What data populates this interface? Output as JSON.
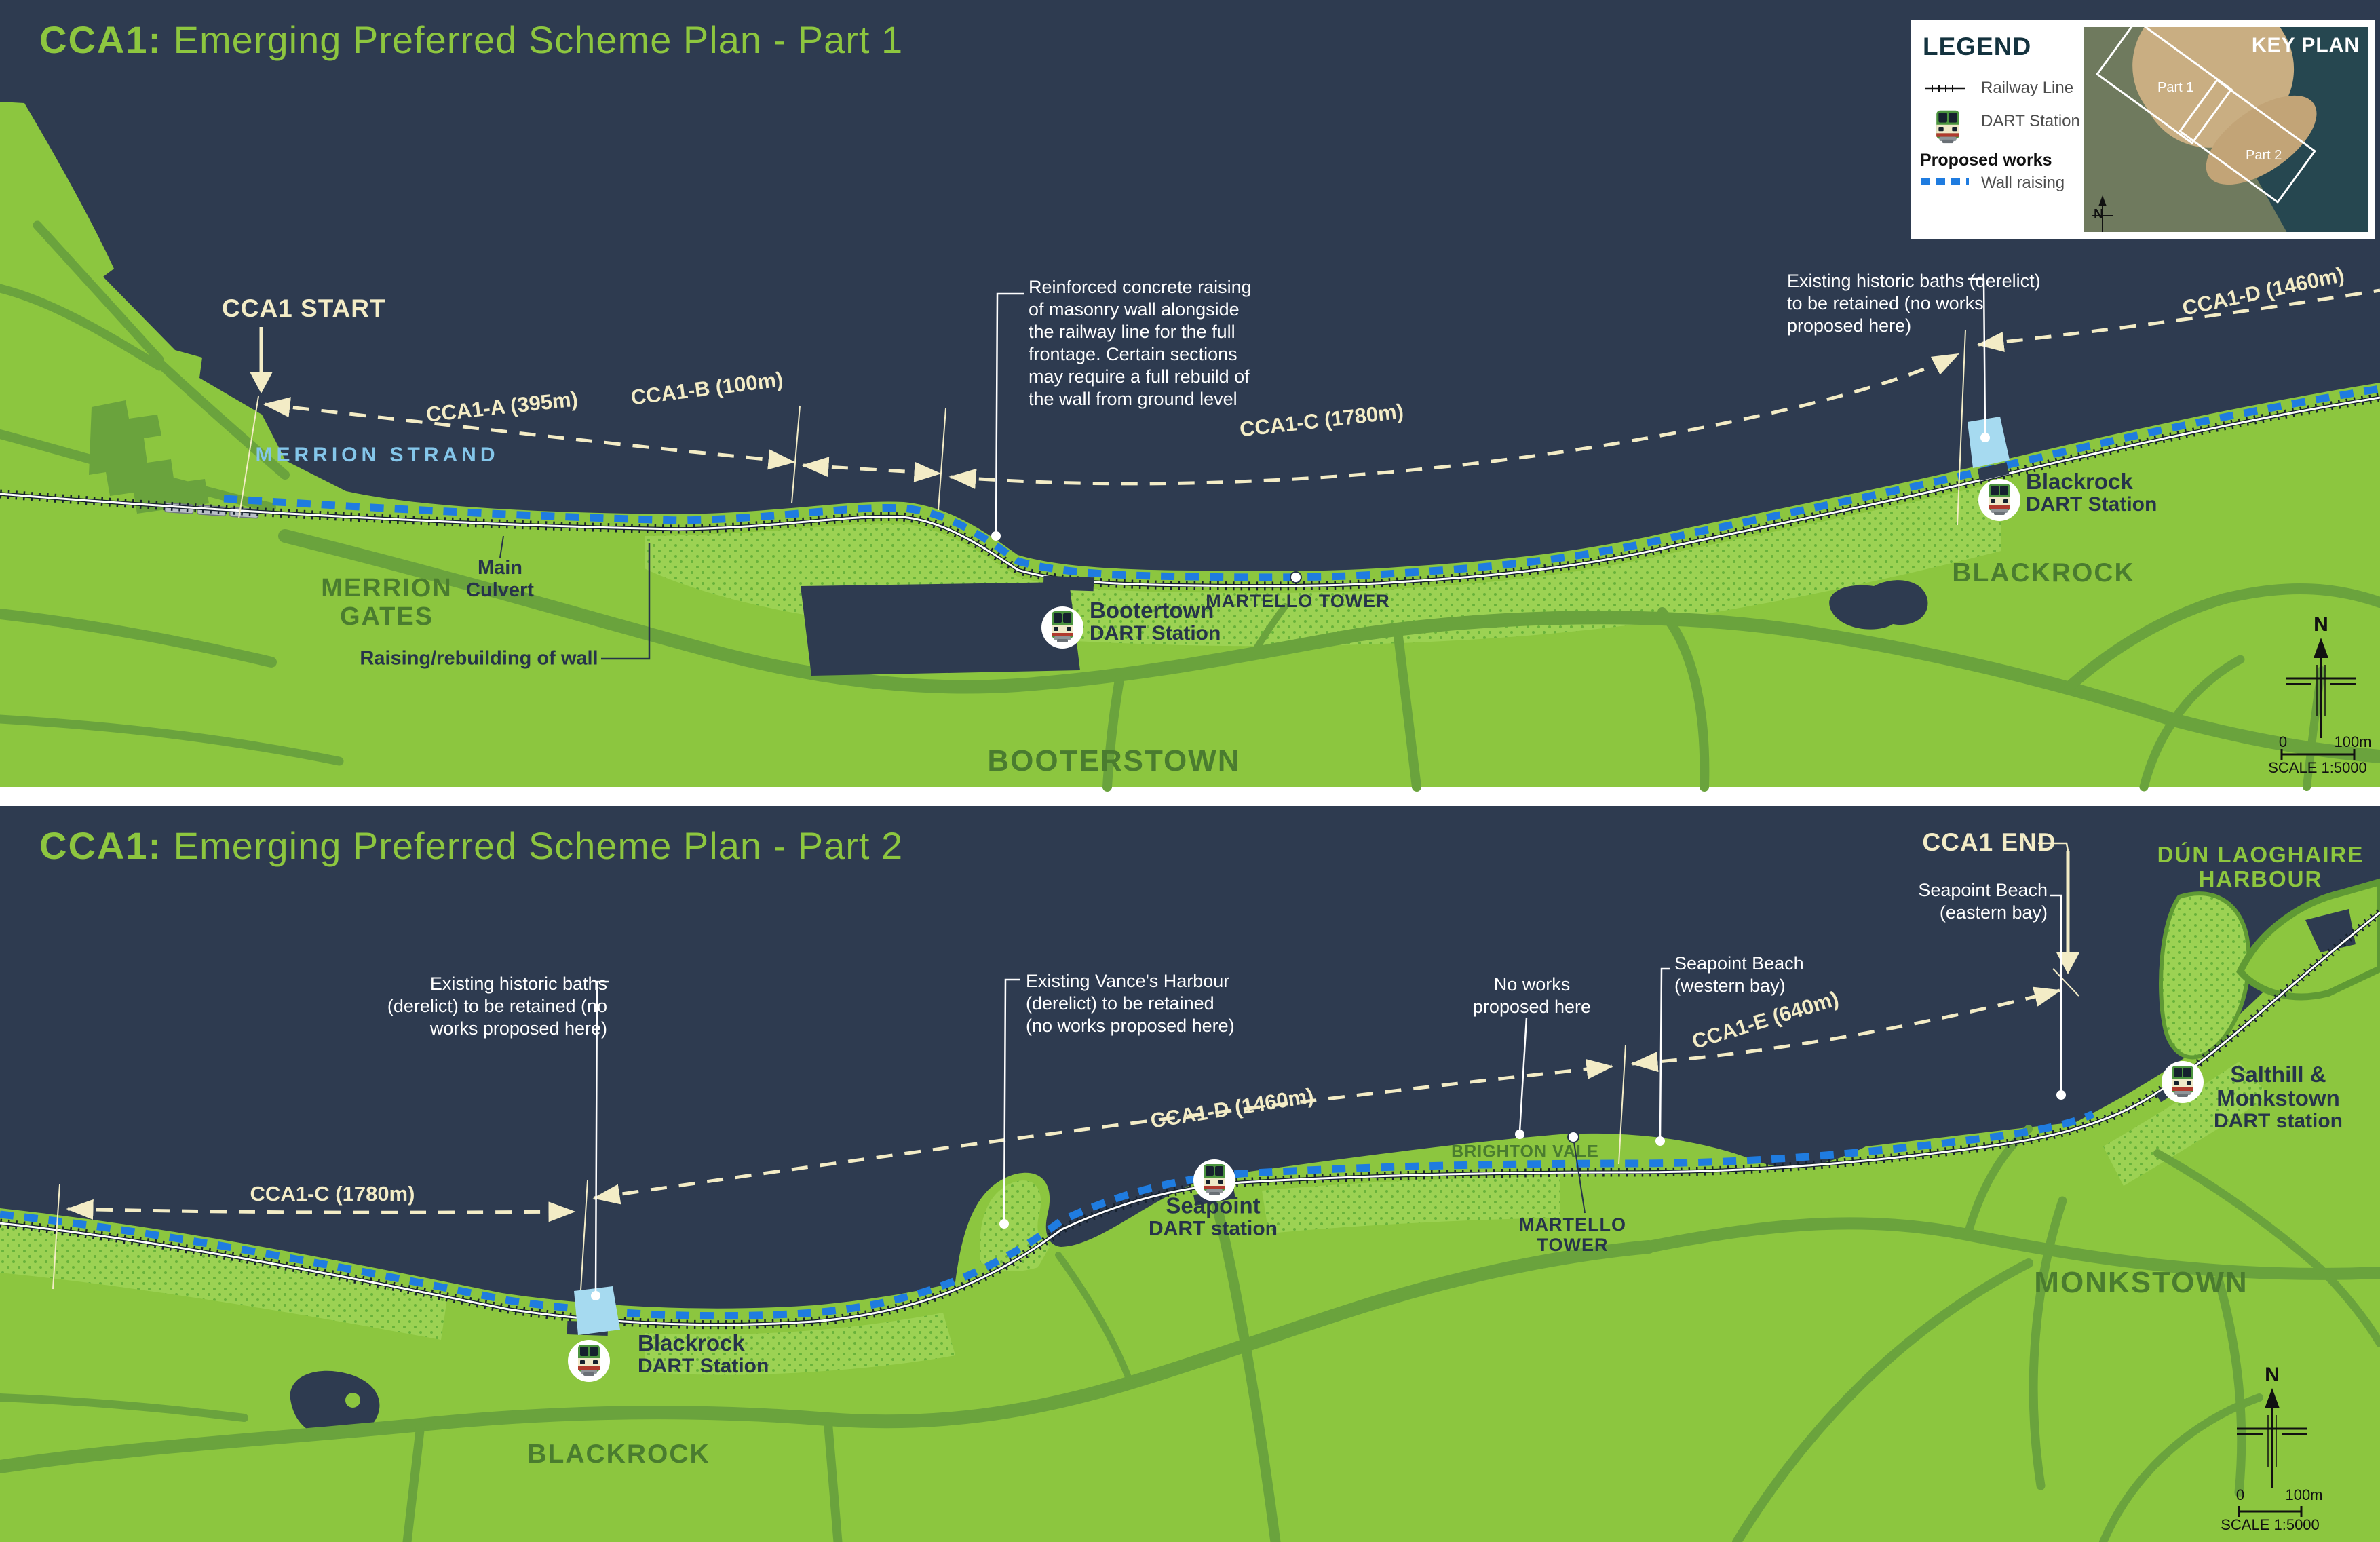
{
  "colors": {
    "sea": "#2e3b50",
    "land": "#8cc63f",
    "land_dotted": "#9cd253",
    "roads": "#6aa33d",
    "wall_raising_blue": "#1f7ce0",
    "dimension_cream": "#f3ecc6",
    "title_green": "#8dc63f",
    "area_label_green": "#4a7c2f",
    "navy_text": "#26344a",
    "strand_blue": "#84c6ea",
    "baths_blue": "#a6daf0"
  },
  "legend": {
    "title": "LEGEND",
    "railway_label": "Railway Line",
    "dart_label": "DART Station",
    "proposed_works": "Proposed works",
    "wall_label": "Wall raising"
  },
  "keyplan": {
    "title": "KEY PLAN",
    "part1": "Part 1",
    "part2": "Part 2",
    "north": "N"
  },
  "part1": {
    "title_bold": "CCA1:",
    "title_rest": " Emerging Preferred Scheme Plan - Part 1",
    "start_label": "CCA1 START",
    "dims": {
      "a": "CCA1-A (395m)",
      "b": "CCA1-B (100m)",
      "c": "CCA1-C (1780m)",
      "d": "CCA1-D (1460m)"
    },
    "merrion_strand": "MERRION STRAND",
    "merrion_gates": [
      "MERRION",
      "GATES"
    ],
    "main_culvert": [
      "Main",
      "Culvert"
    ],
    "raising_wall": "Raising/rebuilding of wall",
    "reinforced_note": [
      "Reinforced concrete raising",
      "of masonry wall alongside",
      "the railway line for the full",
      "frontage. Certain sections",
      "may require a full rebuild of",
      "the wall from ground level"
    ],
    "baths_note": [
      "Existing historic baths (derelict)",
      "to be retained (no works",
      "proposed here)"
    ],
    "martello": "MARTELLO TOWER",
    "stations": {
      "booterstown": {
        "name": "Bootertown",
        "sub": "DART Station"
      },
      "blackrock": {
        "name": "Blackrock",
        "sub": "DART Station"
      }
    },
    "areas": {
      "booterstown": "BOOTERSTOWN",
      "blackrock": "BLACKROCK"
    },
    "scale": {
      "zero": "0",
      "max": "100m",
      "text": "SCALE 1:5000",
      "north": "N"
    }
  },
  "part2": {
    "title_bold": "CCA1:",
    "title_rest": " Emerging Preferred Scheme Plan - Part 2",
    "end_label": "CCA1 END",
    "dims": {
      "c": "CCA1-C (1780m)",
      "d": "CCA1-D (1460m)",
      "e": "CCA1-E (640m)"
    },
    "baths_note": [
      "Existing historic baths",
      "(derelict) to be retained (no",
      "works proposed here)"
    ],
    "vance_note": [
      "Existing Vance's Harbour",
      "(derelict) to be retained",
      "(no works proposed here)"
    ],
    "noworks_note": [
      "No works",
      "proposed here"
    ],
    "seapoint_east": [
      "Seapoint Beach",
      "(eastern bay)"
    ],
    "seapoint_west": [
      "Seapoint Beach",
      "(western bay)"
    ],
    "harbour": [
      "DÚN LAOGHAIRE",
      "HARBOUR"
    ],
    "brighton_vale": "BRIGHTON VALE",
    "martello": [
      "MARTELLO",
      "TOWER"
    ],
    "stations": {
      "blackrock": {
        "name": "Blackrock",
        "sub": "DART Station"
      },
      "seapoint": {
        "name": "Seapoint",
        "sub": "DART station"
      },
      "salthill": {
        "name": "Salthill &",
        "name2": "Monkstown",
        "sub": "DART station"
      }
    },
    "areas": {
      "blackrock": "BLACKROCK",
      "monkstown": "MONKSTOWN"
    },
    "scale": {
      "zero": "0",
      "max": "100m",
      "text": "SCALE 1:5000",
      "north": "N"
    }
  }
}
